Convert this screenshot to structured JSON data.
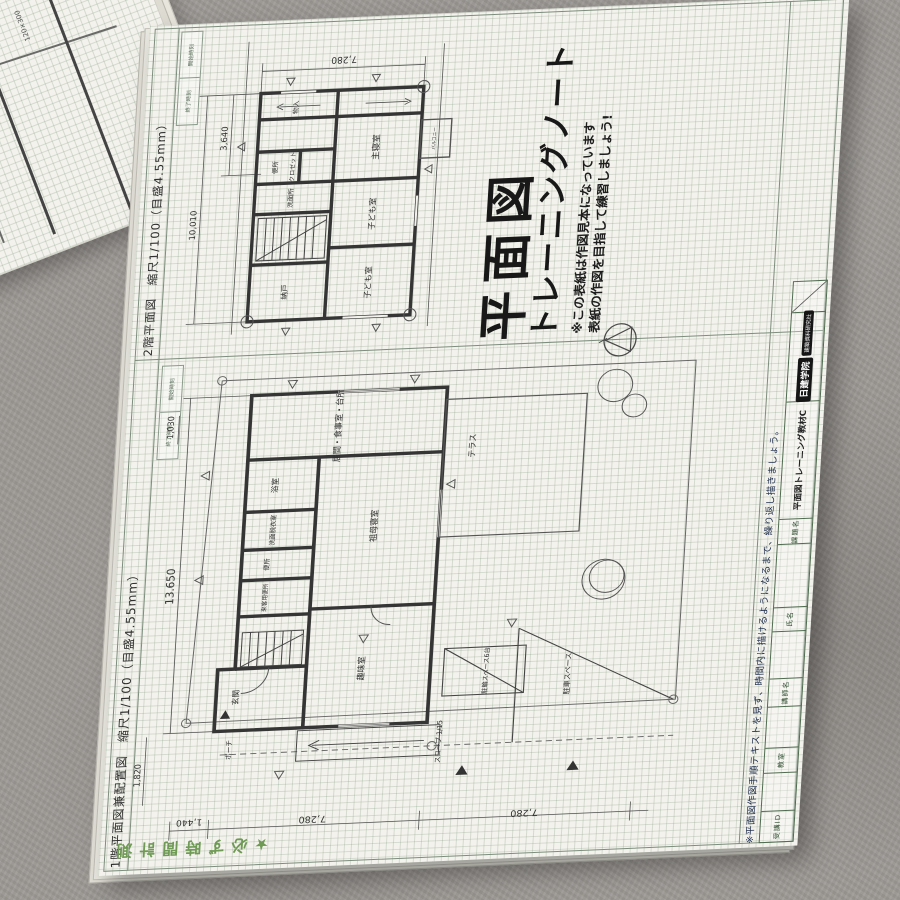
{
  "cover": {
    "title_line1": "平面図",
    "title_line2": "トレーニングノート",
    "note_line1": "※この表紙は作図見本になっています",
    "note_line2": "表紙の作図を目指して練習しましょう!"
  },
  "panels": {
    "plan2_title": "2階平面図　縮尺1/100（目盛4.55mm）",
    "plan1_title": "1階平面図兼配置図　縮尺1/100（目盛4.55mm）"
  },
  "margin_notes": {
    "time_note": "★必ず時間計測",
    "practice_note": "※平面図作図手順テキストを見ず、時間内に描けるようになるまで、繰り返し描きましょう。"
  },
  "form": {
    "student_id": "受講ID",
    "classroom": "教室",
    "instructor": "講師名",
    "name": "氏名",
    "course_label": "課題名",
    "course_value": "平面図トレーニング教材C",
    "school": "日建学院",
    "publisher": "建築資料研究社",
    "start_time": "開始時刻",
    "end_time": "終了時刻"
  },
  "plan1": {
    "rooms": {
      "ldk": "居間・食事室・台所",
      "terrace": "テラス",
      "bath": "浴室",
      "washroom": "洗面脱衣室",
      "toilet": "便所",
      "guest_toilet": "来客用便所",
      "entrance": "玄関",
      "grandmother_bedroom": "祖母寝室",
      "hobby_room": "趣味室",
      "porch": "ポーチ",
      "slope": "スロープ 1/15",
      "bicycle": "駐輪スペース6台",
      "parking": "駐車スペース"
    },
    "dims": {
      "left_total": "13.650",
      "left_bottom": "1,820",
      "top_left": "1,030",
      "bottom_left": "1,440",
      "bottom_mid": "7,280",
      "bottom_right": "7,280"
    }
  },
  "plan2": {
    "rooms": {
      "master_bedroom": "主寝室",
      "child_room1": "子ども室",
      "child_room2": "子ども室",
      "storage_small": "物入",
      "closet": "クロゼット",
      "toilet": "便所",
      "washroom": "洗面所",
      "storeroom": "納戸",
      "balcony": "バルコニー"
    },
    "dims": {
      "top": "7,280",
      "left_upper": "3,640",
      "left_total": "10,010"
    }
  },
  "adjacent_sheet": {
    "texts": [
      "120×300",
      "3,640",
      "2,730"
    ]
  }
}
